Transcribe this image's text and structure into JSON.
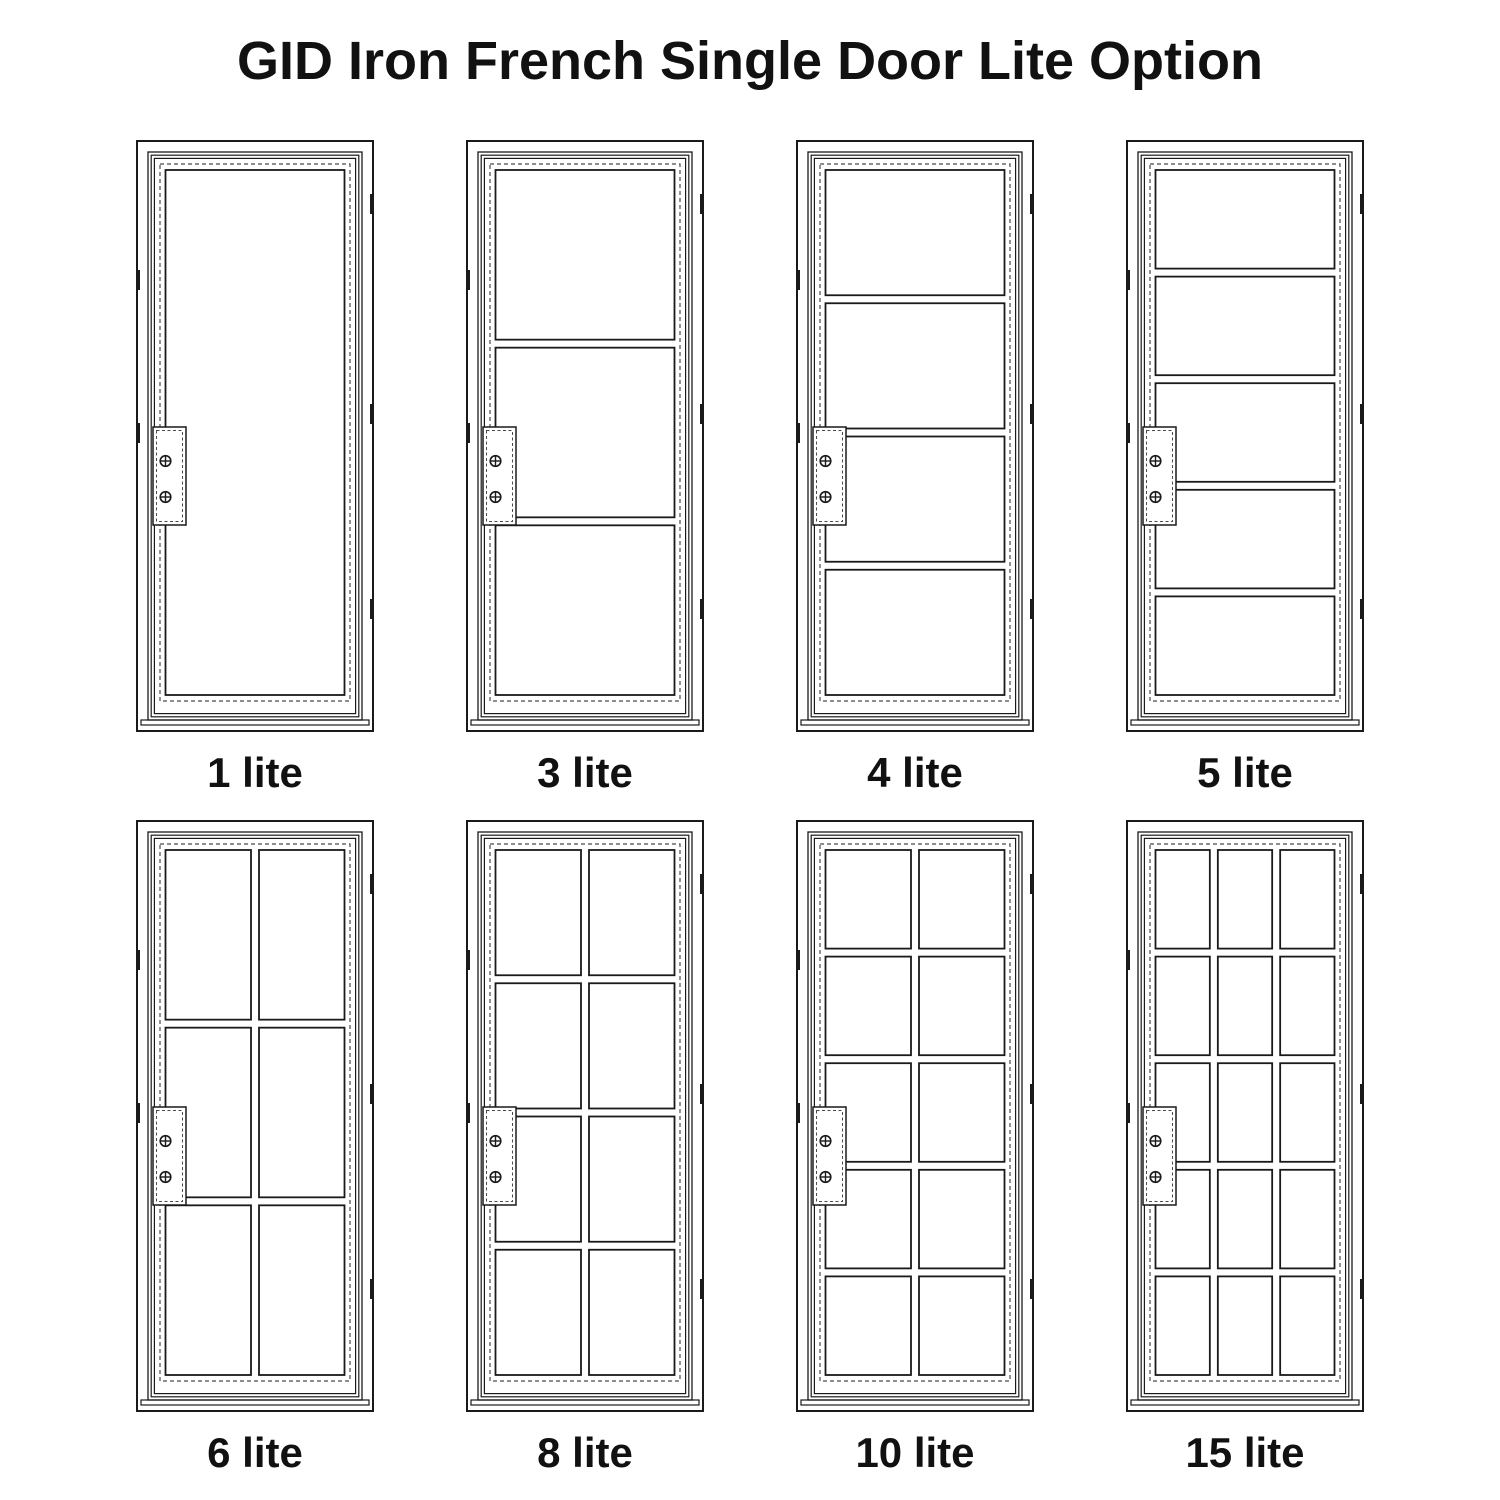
{
  "title": "GID Iron French Single Door Lite Option",
  "doors": [
    {
      "label": "1 lite",
      "lites": 1,
      "rows": 1,
      "cols": 1
    },
    {
      "label": "3 lite",
      "lites": 3,
      "rows": 3,
      "cols": 1
    },
    {
      "label": "4 lite",
      "lites": 4,
      "rows": 4,
      "cols": 1
    },
    {
      "label": "5 lite",
      "lites": 5,
      "rows": 5,
      "cols": 1
    },
    {
      "label": "6 lite",
      "lites": 6,
      "rows": 3,
      "cols": 2
    },
    {
      "label": "8 lite",
      "lites": 8,
      "rows": 4,
      "cols": 2
    },
    {
      "label": "10 lite",
      "lites": 10,
      "rows": 5,
      "cols": 2
    },
    {
      "label": "15 lite",
      "lites": 15,
      "rows": 5,
      "cols": 3
    }
  ],
  "hardware": {
    "lock_screws_per_door": 2,
    "screw_icon": "crossed-circle-screw",
    "hinge_marks_right": 3,
    "hinge_marks_left": 2
  },
  "colors": {
    "line": "#1a1a1a",
    "dashed_line": "#4a4a4a",
    "background": "#ffffff",
    "text": "#111111"
  }
}
